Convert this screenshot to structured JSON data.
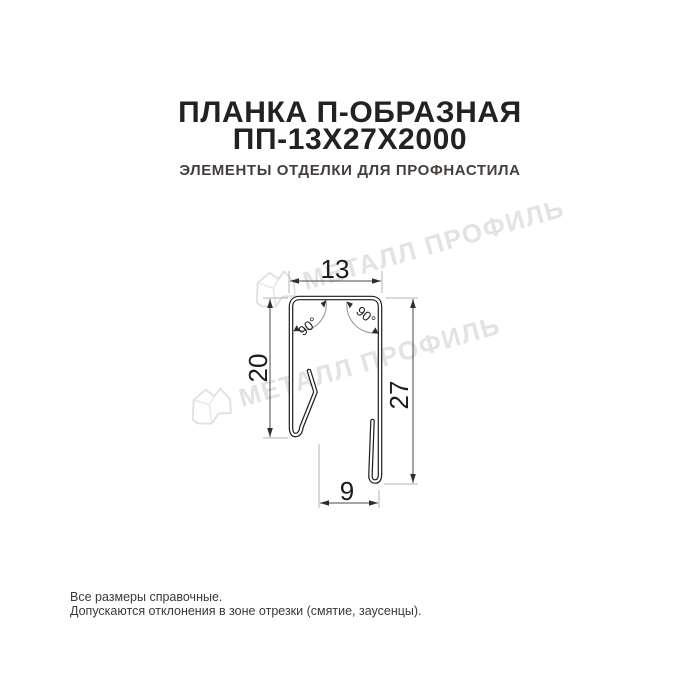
{
  "header": {
    "title_line1": "ПЛАНКА П-ОБРАЗНАЯ",
    "title_line2": "ПП-13Х27Х2000",
    "subtitle": "ЭЛЕМЕНТЫ ОТДЕЛКИ ДЛЯ ПРОФНАСТИЛА"
  },
  "diagram": {
    "dim_top_width": "13",
    "dim_left_height": "20",
    "dim_right_height": "27",
    "dim_bottom_width": "9",
    "angle_left": "90°",
    "angle_right": "90°"
  },
  "watermark": {
    "brand_text": "МЕТАЛЛ ПРОФИЛЬ"
  },
  "footer": {
    "note_line1": "Все размеры справочные.",
    "note_line2": "Допускаются отклонения в зоне отрезки (смятие, заусенцы)."
  },
  "colors": {
    "ink": "#1c1c1c",
    "dimension_line": "#4a4a4a",
    "extension_line": "#b3b3b3",
    "watermark": "#e3e3e3",
    "subtitle": "#453f3c",
    "background": "#ffffff"
  }
}
